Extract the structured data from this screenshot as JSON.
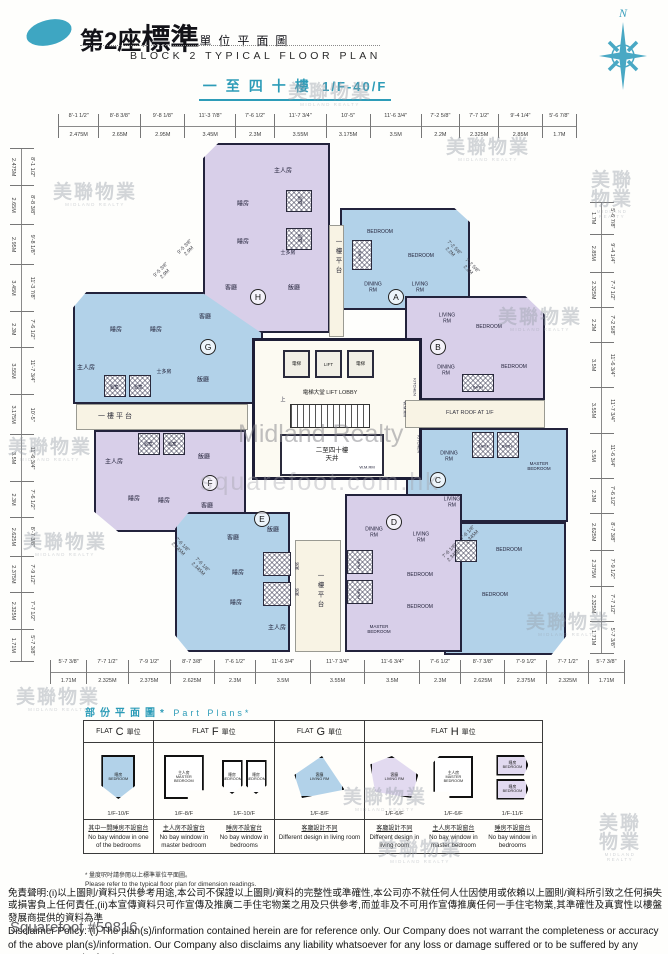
{
  "header": {
    "block_no_cn": "第2座",
    "title_cn_big": "標準",
    "title_cn_small": "單位平面圖",
    "title_en": "BLOCK 2 TYPICAL FLOOR PLAN",
    "floor_range_cn": "一至四十樓",
    "floor_range_en": "1/F-40/F",
    "compass_label": "N"
  },
  "rulers": {
    "top": [
      {
        "ft": "8'-1 1/2\"",
        "m": "2.475M"
      },
      {
        "ft": "8'-8 3/8\"",
        "m": "2.65M"
      },
      {
        "ft": "9'-8 1/8\"",
        "m": "2.95M"
      },
      {
        "ft": "11'-3 7/8\"",
        "m": "3.45M"
      },
      {
        "ft": "7'-6 1/2\"",
        "m": "2.3M"
      },
      {
        "ft": "11'-7 3/4\"",
        "m": "3.55M"
      },
      {
        "ft": "10'-5\"",
        "m": "3.175M"
      },
      {
        "ft": "11'-6 3/4\"",
        "m": "3.5M"
      },
      {
        "ft": "7'-2 5/8\"",
        "m": "2.2M"
      },
      {
        "ft": "7'-7 1/2\"",
        "m": "2.325M"
      },
      {
        "ft": "9'-4 1/4\"",
        "m": "2.85M"
      },
      {
        "ft": "5'-6 7/8\"",
        "m": "1.7M"
      }
    ],
    "left": [
      {
        "ft": "8'-1 1/2\"",
        "m": "2.475M"
      },
      {
        "ft": "8'-8 3/8\"",
        "m": "2.65M"
      },
      {
        "ft": "9'-8 1/8\"",
        "m": "2.95M"
      },
      {
        "ft": "11'-3 7/8\"",
        "m": "3.45M"
      },
      {
        "ft": "7'-6 1/2\"",
        "m": "2.3M"
      },
      {
        "ft": "11'-7 3/4\"",
        "m": "3.55M"
      },
      {
        "ft": "10'-5\"",
        "m": "3.175M"
      },
      {
        "ft": "11'-6 3/4\"",
        "m": "3.5M"
      },
      {
        "ft": "7'-6 1/2\"",
        "m": "2.3M"
      },
      {
        "ft": "8'-7 3/8\"",
        "m": "2.625M"
      },
      {
        "ft": "7'-9 1/2\"",
        "m": "2.375M"
      },
      {
        "ft": "7'-7 1/2\"",
        "m": "2.325M"
      },
      {
        "ft": "5'-7 3/8\"",
        "m": "1.71M"
      }
    ],
    "right": [
      {
        "ft": "5'-6 7/8\"",
        "m": "1.7M"
      },
      {
        "ft": "9'-4 1/4\"",
        "m": "2.85M"
      },
      {
        "ft": "7'-7 1/2\"",
        "m": "2.325M"
      },
      {
        "ft": "7'-2 5/8\"",
        "m": "2.2M"
      },
      {
        "ft": "11'-6 3/4\"",
        "m": "3.5M"
      },
      {
        "ft": "11'-7 3/4\"",
        "m": "3.55M"
      },
      {
        "ft": "11'-6 3/4\"",
        "m": "3.5M"
      },
      {
        "ft": "7'-6 1/2\"",
        "m": "2.3M"
      },
      {
        "ft": "8'-7 3/8\"",
        "m": "2.625M"
      },
      {
        "ft": "7'-9 1/2\"",
        "m": "2.375M"
      },
      {
        "ft": "7'-7 1/2\"",
        "m": "2.325M"
      },
      {
        "ft": "5'-7 3/8\"",
        "m": "1.71M"
      }
    ],
    "bottom": [
      {
        "ft": "5'-7 3/8\"",
        "m": "1.71M"
      },
      {
        "ft": "7'-7 1/2\"",
        "m": "2.325M"
      },
      {
        "ft": "7'-9 1/2\"",
        "m": "2.375M"
      },
      {
        "ft": "8'-7 3/8\"",
        "m": "2.625M"
      },
      {
        "ft": "7'-6 1/2\"",
        "m": "2.3M"
      },
      {
        "ft": "11'-6 3/4\"",
        "m": "3.5M"
      },
      {
        "ft": "11'-7 3/4\"",
        "m": "3.55M"
      },
      {
        "ft": "11'-6 3/4\"",
        "m": "3.5M"
      },
      {
        "ft": "7'-6 1/2\"",
        "m": "2.3M"
      },
      {
        "ft": "8'-7 3/8\"",
        "m": "2.625M"
      },
      {
        "ft": "7'-9 1/2\"",
        "m": "2.375M"
      },
      {
        "ft": "7'-7 1/2\"",
        "m": "2.325M"
      },
      {
        "ft": "5'-7 3/8\"",
        "m": "1.71M"
      }
    ]
  },
  "core": {
    "lift_cn_left": "電梯",
    "lift_en": "LIFT",
    "lift_cn_right": "電梯",
    "lobby": "電梯大堂  LIFT LOBBY",
    "lightwell": "二至四十樓\n天井"
  },
  "areas": {
    "podium_left": "一樓平台",
    "podium_top": "一樓平台",
    "podium_bottom": "一樓平台",
    "flat_roof": "FLAT ROOF AT 1/F"
  },
  "room_labels": [
    {
      "t": "主人房",
      "x": 283,
      "y": 172
    },
    {
      "t": "睡房",
      "x": 243,
      "y": 205
    },
    {
      "t": "睡房",
      "x": 243,
      "y": 243
    },
    {
      "t": "浴室",
      "x": 300,
      "y": 200,
      "fs": 4.5,
      "rot": 90
    },
    {
      "t": "浴室",
      "x": 300,
      "y": 238,
      "fs": 4.5,
      "rot": 90
    },
    {
      "t": "士多房",
      "x": 288,
      "y": 254,
      "fs": 5
    },
    {
      "t": "客廳",
      "x": 231,
      "y": 289
    },
    {
      "t": "飯廳",
      "x": 294,
      "y": 289
    },
    {
      "t": "BEDROOM",
      "x": 380,
      "y": 233,
      "fs": 5
    },
    {
      "t": "BEDROOM",
      "x": 421,
      "y": 257,
      "fs": 5
    },
    {
      "t": "BATH",
      "x": 359,
      "y": 256,
      "fs": 4,
      "rot": 90
    },
    {
      "t": "DINING\nRM",
      "x": 373,
      "y": 288,
      "fs": 5
    },
    {
      "t": "LIVING\nRM",
      "x": 420,
      "y": 288,
      "fs": 5
    },
    {
      "t": "LIVING\nRM",
      "x": 447,
      "y": 319,
      "fs": 5
    },
    {
      "t": "BEDROOM",
      "x": 489,
      "y": 328,
      "fs": 5
    },
    {
      "t": "DINING\nRM",
      "x": 446,
      "y": 371,
      "fs": 5
    },
    {
      "t": "BEDROOM",
      "x": 514,
      "y": 368,
      "fs": 5
    },
    {
      "t": "BATH",
      "x": 478,
      "y": 388,
      "fs": 4
    },
    {
      "t": "KITCHEN",
      "x": 414,
      "y": 387,
      "fs": 4,
      "rot": 90
    },
    {
      "t": "KITCHEN",
      "x": 418,
      "y": 444,
      "fs": 4,
      "rot": 90
    },
    {
      "t": "BATH",
      "x": 483,
      "y": 447,
      "fs": 4
    },
    {
      "t": "BATH",
      "x": 507,
      "y": 447,
      "fs": 4
    },
    {
      "t": "DINING\nRM",
      "x": 449,
      "y": 457,
      "fs": 5
    },
    {
      "t": "MASTER\nBEDROOM",
      "x": 539,
      "y": 466,
      "fs": 4.5
    },
    {
      "t": "LIVING\nRM",
      "x": 452,
      "y": 503,
      "fs": 5
    },
    {
      "t": "BEDROOM",
      "x": 509,
      "y": 551,
      "fs": 5
    },
    {
      "t": "BEDROOM",
      "x": 495,
      "y": 596,
      "fs": 5
    },
    {
      "t": "DINING\nRM",
      "x": 374,
      "y": 533,
      "fs": 5
    },
    {
      "t": "LIVING\nRM",
      "x": 421,
      "y": 538,
      "fs": 5
    },
    {
      "t": "BEDROOM",
      "x": 420,
      "y": 576,
      "fs": 5
    },
    {
      "t": "BEDROOM",
      "x": 420,
      "y": 608,
      "fs": 5
    },
    {
      "t": "MASTER\nBEDROOM",
      "x": 379,
      "y": 629,
      "fs": 4.5
    },
    {
      "t": "BATH",
      "x": 358,
      "y": 564,
      "fs": 4,
      "rot": 90
    },
    {
      "t": "BATH",
      "x": 358,
      "y": 594,
      "fs": 4,
      "rot": 90
    },
    {
      "t": "飯廳",
      "x": 273,
      "y": 531
    },
    {
      "t": "客廳",
      "x": 233,
      "y": 539
    },
    {
      "t": "睡房",
      "x": 238,
      "y": 574
    },
    {
      "t": "睡房",
      "x": 236,
      "y": 604
    },
    {
      "t": "主人房",
      "x": 277,
      "y": 629
    },
    {
      "t": "浴室",
      "x": 296,
      "y": 566,
      "fs": 4,
      "rot": 90
    },
    {
      "t": "浴室",
      "x": 296,
      "y": 592,
      "fs": 4,
      "rot": 90
    },
    {
      "t": "浴室",
      "x": 148,
      "y": 444,
      "fs": 4.5
    },
    {
      "t": "浴室",
      "x": 172,
      "y": 444,
      "fs": 4.5
    },
    {
      "t": "主人房",
      "x": 114,
      "y": 463
    },
    {
      "t": "飯廳",
      "x": 204,
      "y": 458
    },
    {
      "t": "睡房",
      "x": 134,
      "y": 500
    },
    {
      "t": "睡房",
      "x": 164,
      "y": 502
    },
    {
      "t": "客廳",
      "x": 207,
      "y": 507
    },
    {
      "t": "睡房",
      "x": 116,
      "y": 331
    },
    {
      "t": "睡房",
      "x": 156,
      "y": 331
    },
    {
      "t": "客廳",
      "x": 205,
      "y": 318
    },
    {
      "t": "主人房",
      "x": 86,
      "y": 369
    },
    {
      "t": "浴室",
      "x": 114,
      "y": 387,
      "fs": 4.5
    },
    {
      "t": "浴室",
      "x": 138,
      "y": 387,
      "fs": 4.5
    },
    {
      "t": "士多房",
      "x": 164,
      "y": 373,
      "fs": 5
    },
    {
      "t": "飯廳",
      "x": 203,
      "y": 381
    },
    {
      "t": "上",
      "x": 283,
      "y": 401,
      "fs": 5
    },
    {
      "t": "W.M.RM",
      "x": 404,
      "y": 409,
      "fs": 4,
      "rot": 90
    },
    {
      "t": "W.M.RM",
      "x": 367,
      "y": 468,
      "fs": 4
    }
  ],
  "unit_badges": [
    {
      "t": "A",
      "x": 396,
      "y": 297
    },
    {
      "t": "B",
      "x": 438,
      "y": 347
    },
    {
      "t": "C",
      "x": 438,
      "y": 480
    },
    {
      "t": "D",
      "x": 394,
      "y": 522
    },
    {
      "t": "E",
      "x": 262,
      "y": 519
    },
    {
      "t": "F",
      "x": 210,
      "y": 483
    },
    {
      "t": "G",
      "x": 208,
      "y": 347
    },
    {
      "t": "H",
      "x": 258,
      "y": 297
    }
  ],
  "diag_dims": [
    {
      "ft": "9'-5 3/8\"",
      "m": "2.9M",
      "x": 163,
      "y": 272,
      "rot": -45
    },
    {
      "ft": "9'-5 3/8\"",
      "m": "2.9M",
      "x": 187,
      "y": 249,
      "rot": -45
    },
    {
      "ft": "7'-2 5/8\"",
      "m": "2.2M",
      "x": 452,
      "y": 250,
      "rot": 45
    },
    {
      "ft": "7'-2 5/8\"",
      "m": "2.2M",
      "x": 470,
      "y": 268,
      "rot": 45
    },
    {
      "ft": "7'-6 1/8\"",
      "m": "2.345M",
      "x": 180,
      "y": 547,
      "rot": 45
    },
    {
      "ft": "7'-6 1/8\"",
      "m": "2.345M",
      "x": 200,
      "y": 567,
      "rot": 45
    },
    {
      "ft": "7'-6 1/8\"",
      "m": "2.345M",
      "x": 452,
      "y": 553,
      "rot": -45
    },
    {
      "ft": "7'-6 1/8\"",
      "m": "2.345M",
      "x": 470,
      "y": 535,
      "rot": -45
    }
  ],
  "hatches": [
    {
      "x": 286,
      "y": 190,
      "w": 26,
      "h": 22
    },
    {
      "x": 286,
      "y": 228,
      "w": 26,
      "h": 22
    },
    {
      "x": 352,
      "y": 240,
      "w": 20,
      "h": 30
    },
    {
      "x": 462,
      "y": 374,
      "w": 32,
      "h": 18
    },
    {
      "x": 472,
      "y": 432,
      "w": 22,
      "h": 26
    },
    {
      "x": 497,
      "y": 432,
      "w": 22,
      "h": 26
    },
    {
      "x": 347,
      "y": 550,
      "w": 26,
      "h": 24
    },
    {
      "x": 347,
      "y": 580,
      "w": 26,
      "h": 24
    },
    {
      "x": 263,
      "y": 552,
      "w": 28,
      "h": 24
    },
    {
      "x": 263,
      "y": 582,
      "w": 28,
      "h": 24
    },
    {
      "x": 138,
      "y": 433,
      "w": 22,
      "h": 22
    },
    {
      "x": 163,
      "y": 433,
      "w": 22,
      "h": 22
    },
    {
      "x": 104,
      "y": 375,
      "w": 22,
      "h": 22
    },
    {
      "x": 129,
      "y": 375,
      "w": 22,
      "h": 22
    },
    {
      "x": 455,
      "y": 540,
      "w": 22,
      "h": 22
    }
  ],
  "stamps": [
    {
      "cn": "美聯物業",
      "en": "MIDLAND REALTY",
      "x": 95,
      "y": 195
    },
    {
      "cn": "美聯物業",
      "en": "MIDLAND REALTY",
      "x": 50,
      "y": 450
    },
    {
      "cn": "美聯物業",
      "en": "MIDLAND REALTY",
      "x": 58,
      "y": 700
    },
    {
      "cn": "美聯物業",
      "en": "MIDLAND REALTY",
      "x": 330,
      "y": 95
    },
    {
      "cn": "美聯物業",
      "en": "MIDLAND REALTY",
      "x": 488,
      "y": 150
    },
    {
      "cn": "美聯物業",
      "en": "MIDLAND REALTY",
      "x": 612,
      "y": 195
    },
    {
      "cn": "美聯物業",
      "en": "MIDLAND REALTY",
      "x": 540,
      "y": 320
    },
    {
      "cn": "美聯物業",
      "en": "MIDLAND REALTY",
      "x": 568,
      "y": 625
    },
    {
      "cn": "美聯物業",
      "en": "MIDLAND REALTY",
      "x": 65,
      "y": 545
    },
    {
      "cn": "美聯物業",
      "en": "MIDLAND REALTY",
      "x": 385,
      "y": 800
    },
    {
      "cn": "美聯物業",
      "en": "MIDLAND REALTY",
      "x": 420,
      "y": 852
    },
    {
      "cn": "美聯物業",
      "en": "MIDLAND REALTY",
      "x": 620,
      "y": 838
    }
  ],
  "watermarks": {
    "center": "Midland Realty",
    "bottom": "squarefoot.com.hk",
    "ref": "Squarefoot #59816"
  },
  "part_plans": {
    "title_cn": "部份平面圖*",
    "title_en": "Part Plans*",
    "headers": {
      "c": {
        "pre": "FLAT",
        "letter": "C",
        "post": "單位"
      },
      "f": {
        "pre": "FLAT",
        "letter": "F",
        "post": "單位"
      },
      "g": {
        "pre": "FLAT",
        "letter": "G",
        "post": "單位"
      },
      "h": {
        "pre": "FLAT",
        "letter": "H",
        "post": "單位"
      }
    },
    "cells": {
      "c1": {
        "room_cn": "睡房",
        "room_en": "BEDROOM",
        "floors": "1/F-10/F",
        "note_cn": "其中一間睡房不設窗台",
        "note_en": "No bay window in one of the bedrooms"
      },
      "f1": {
        "room_cn": "主人房",
        "room_en": "MASTER BEDROOM",
        "floors": "1/F-8/F",
        "note_cn": "主人房不設窗台",
        "note_en": "No bay window in master bedroom"
      },
      "f2": {
        "room_cn": "睡房",
        "room_en": "BEDROOM",
        "room_cn2": "睡房",
        "room_en2": "BEDROOM",
        "floors": "1/F-10/F",
        "note_cn": "睡房不設窗台",
        "note_en": "No bay window in bedrooms"
      },
      "g1": {
        "room_cn": "客廳",
        "room_en": "LIVING RM",
        "floors": "1/F-8/F",
        "note_cn": "客廳設計不同",
        "note_en": "Different design in living room"
      },
      "h1": {
        "room_cn": "客廳",
        "room_en": "LIVING RM",
        "floors": "1/F-6/F",
        "note_cn": "客廳設計不同",
        "note_en": "Different design in living room"
      },
      "h2": {
        "room_cn": "主人房",
        "room_en": "MASTER BEDROOM",
        "floors": "1/F-6/F",
        "note_cn": "主人房不設窗台",
        "note_en": "No bay window in master bedroom"
      },
      "h3": {
        "room_cn": "睡房",
        "room_en": "BEDROOM",
        "room_cn2": "睡房",
        "room_en2": "BEDROOM",
        "floors": "1/F-11/F",
        "note_cn": "睡房不設窗台",
        "note_en": "No bay window in bedrooms"
      }
    }
  },
  "footnote": {
    "cn": "* 量度呎吋請參閱以上標準單位平面圖。",
    "en": "Please refer to the typical floor plan for dimension readings."
  },
  "disclaimer": {
    "cn": "免責聲明:(i)以上圖則/資料只供參考用途,本公司不保證以上圖則/資料的完整性或準確性,本公司亦不就任何人仕因使用或依賴以上圖則/資料所引致之任何損失或損害負上任何責任,(ii)本宣傳資料只可作宣傳及推廣二手住宅物業之用及只供參考,而並非及不可用作宣傳推廣任何一手住宅物業,其準確性及真實性以樓盤發展商提供的資料為準",
    "en": "Disclaimer Policy: (i) The plan(s)/information contained herein are for reference only. Our Company does not warrant the completeness or accuracy of the above plan(s)/information. Our Company also disclaims any liability whatsoever for any loss or damage suffered or to be suffered by any person as a result of using or"
  }
}
